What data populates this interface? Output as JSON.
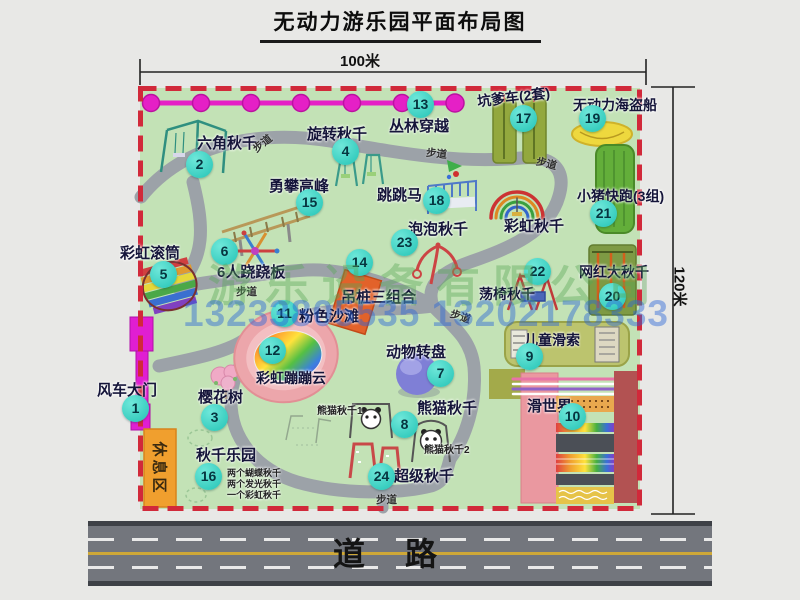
{
  "title": "无动力游乐园平面布局图",
  "dimensions": {
    "width": "100米",
    "height": "120米"
  },
  "road": {
    "label": "道路"
  },
  "path_label": "步道",
  "watermark": {
    "company": "游乐设备有限公司",
    "phone": "13233805535 13202178333"
  },
  "rest_area": {
    "label": "休息区"
  },
  "facilities": [
    {
      "num": "1",
      "name": "风车大门"
    },
    {
      "num": "2",
      "name": "六角秋千"
    },
    {
      "num": "3",
      "name": "樱花树"
    },
    {
      "num": "4",
      "name": "旋转秋千"
    },
    {
      "num": "5",
      "name": "彩虹滚筒"
    },
    {
      "num": "6",
      "name": "6人跷跷板"
    },
    {
      "num": "7",
      "name": "动物转盘"
    },
    {
      "num": "8",
      "name": "熊猫秋千"
    },
    {
      "num": "9",
      "name": "儿童滑索"
    },
    {
      "num": "10",
      "name": "滑世界"
    },
    {
      "num": "11",
      "name": "粉色沙滩"
    },
    {
      "num": "12",
      "name": "彩虹蹦蹦云"
    },
    {
      "num": "13",
      "name": "丛林穿越"
    },
    {
      "num": "14",
      "name": "吊桩三组合"
    },
    {
      "num": "15",
      "name": "勇攀高峰"
    },
    {
      "num": "16",
      "name": "秋千乐园"
    },
    {
      "num": "17",
      "name": "坑爹车(2套)"
    },
    {
      "num": "18",
      "name": "跳跳马"
    },
    {
      "num": "19",
      "name": "无动力海盗船"
    },
    {
      "num": "20",
      "name": "网红大秋千"
    },
    {
      "num": "21",
      "name": "小猪快跑(3组)"
    },
    {
      "num": "22",
      "name": "荡椅秋千"
    },
    {
      "num": "23",
      "name": "泡泡秋千"
    },
    {
      "num": "24",
      "name": "超级秋千"
    }
  ],
  "unnumbered": {
    "rainbow_swing": "彩虹秋千"
  },
  "sub_labels": {
    "panda1": "熊猫秋千1",
    "panda2": "熊猫秋千2",
    "swing_items": [
      "两个蝴蝶秋千",
      "两个发光秋千",
      "一个彩虹秋千"
    ]
  }
}
